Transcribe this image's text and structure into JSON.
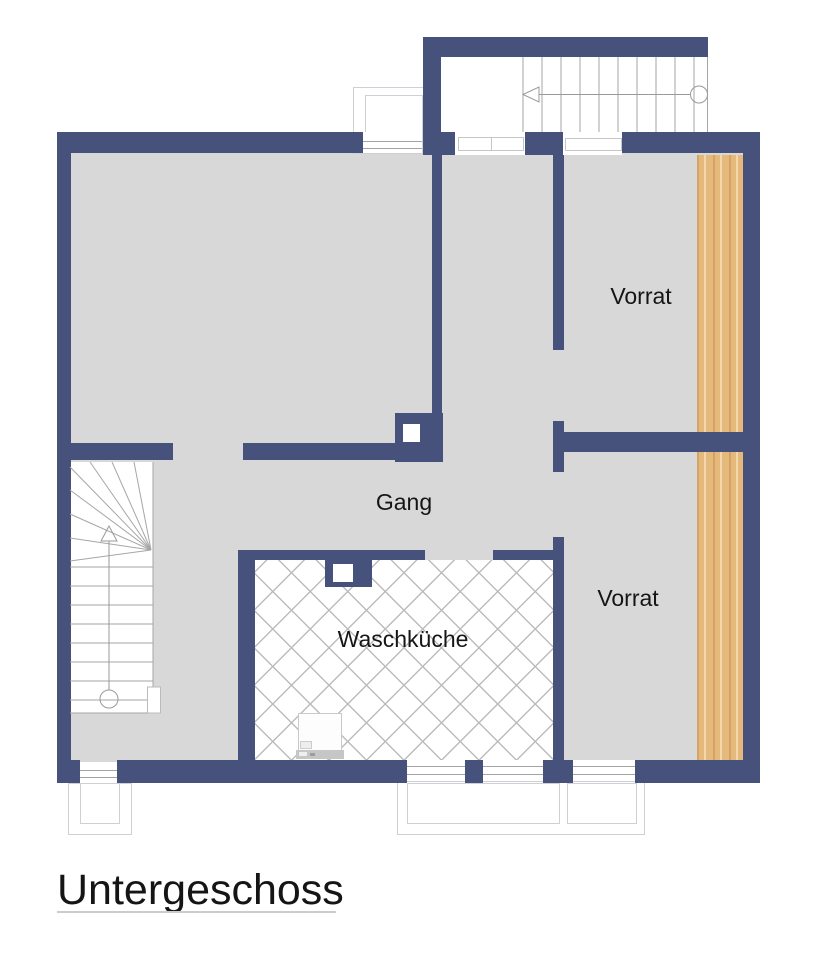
{
  "title": "Untergeschoss",
  "rooms": {
    "vorrat_top": {
      "label": "Vorrat"
    },
    "vorrat_bottom": {
      "label": "Vorrat"
    },
    "gang": {
      "label": "Gang"
    },
    "waschkueche": {
      "label": "Waschküche"
    }
  },
  "icons": {
    "upper_stairs_direction": "walk-arrow-left",
    "lower_stairs_direction": "walk-arrow-up",
    "newel_symbol": "circle"
  },
  "colors": {
    "wall": "#46527b",
    "floor": "#d8d8d8",
    "wood": "#e5b87c",
    "wood_streak": "#d2a05f",
    "hatch_line": "#bcbcbc",
    "line": "#a3a3a3",
    "outline": "#cdd1d6",
    "text": "#151515",
    "underline": "#cccccc"
  }
}
